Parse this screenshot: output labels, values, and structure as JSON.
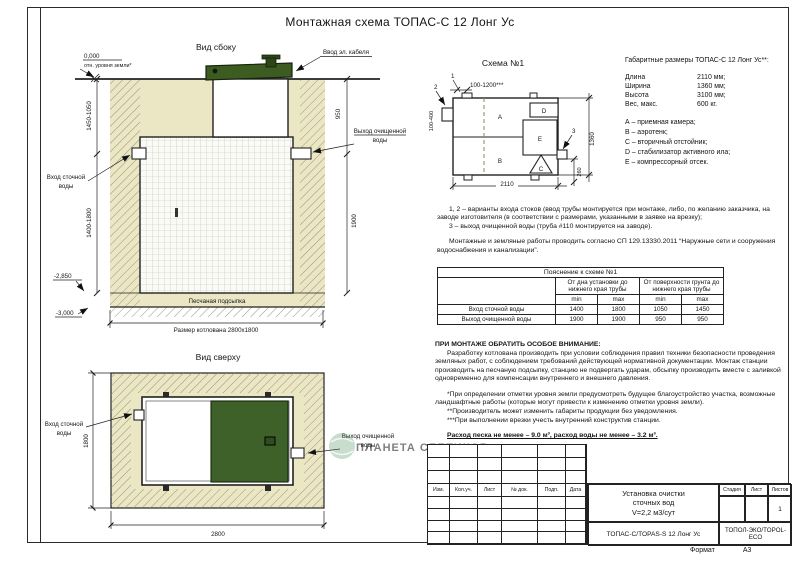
{
  "colors": {
    "sand": "#ebe6c4",
    "lid_green": "#3c5c22",
    "watermark_green": "#9ecfb6",
    "line": "#1a1a1a"
  },
  "page": {
    "title": "Монтажная схема ТОПАС-С 12 Лонг Ус",
    "format_label": "Формат",
    "format_value": "А3"
  },
  "side_view": {
    "title": "Вид сбоку",
    "zero_level": "0,000",
    "zero_note": "отн. уровня земли*",
    "cable_label": "Ввод эл. кабеля",
    "inlet_label": [
      "Вход сточной",
      "воды"
    ],
    "outlet_label": [
      "Выход очищенной",
      "воды"
    ],
    "sand_label": "Песчаная подсыпка",
    "pit_label": "Размер котлована 2800х1800",
    "dims": {
      "ground_to_inlet": "1450-1050",
      "inlet_to_bottom": "1400-1800",
      "level_sand": "-2,850",
      "level_bottom": "-3,000",
      "ground_to_outlet": "950",
      "outlet_to_bottom": "1900"
    }
  },
  "schema": {
    "title": "Схема №1",
    "compartments": [
      "A",
      "B",
      "C",
      "D",
      "E"
    ],
    "callouts": [
      "1",
      "2",
      "3"
    ],
    "dims": {
      "top": "100-1200***",
      "left": "100-400",
      "right": "1360",
      "outlet": "260",
      "bottom": "2110"
    }
  },
  "specs": {
    "title": "Габаритные размеры ТОПАС-С 12 Лонг Ус**:",
    "rows": [
      {
        "label": "Длина",
        "value": "2110 мм;"
      },
      {
        "label": "Ширина",
        "value": "1360 мм;"
      },
      {
        "label": "Высота",
        "value": "3100 мм;"
      },
      {
        "label": "Вес, макс.",
        "value": "600 кг."
      }
    ],
    "legend": [
      "А – приемная камера;",
      "В – аэротенк;",
      "С – вторичный отстойник;",
      "D – стабилизатор активного ила;",
      "Е – компрессорный отсек."
    ]
  },
  "notes": {
    "item12": "1, 2 – варианты входа стоков (ввод трубы монтируется при монтаже, либо, по желанию заказчика, на заводе изготовителя (в соответствии с размерами, указанными в заявке на врезку);",
    "item3": "3 – выход очищенной воды (труба #110 монтируется на заводе).",
    "norm": "Монтажные и земляные работы проводить согласно СП 129.13330.2011 “Наружные сети и сооружения водоснабжения и канализации”."
  },
  "explanation_table": {
    "title": "Пояснение к схеме №1",
    "group1": "От дна установки до нижнего края трубы",
    "group2": "От поверхности грунта до нижнего края трубы",
    "sub": [
      "min",
      "max",
      "min",
      "max"
    ],
    "rows": [
      {
        "label": "Вход сточной воды",
        "v": [
          "1400",
          "1800",
          "1050",
          "1450"
        ]
      },
      {
        "label": "Выход очищенной воды",
        "v": [
          "1900",
          "1900",
          "950",
          "950"
        ]
      }
    ]
  },
  "attention": {
    "title": "ПРИ МОНТАЖЕ ОБРАТИТЬ ОСОБОЕ ВНИМАНИЕ:",
    "p1": "Разработку котлована производить при условии соблюдения правил техники безопасности проведения земляных работ, с соблюдением требований действующей нормативной документации. Монтаж станции производить на песчаную подсыпку, станцию не подвергать ударам, обсыпку производить вместе с заливкой одновременно для компенсации внутреннего и внешнего давления.",
    "f1": "*При определении отметки уровня земли предусмотреть будущее благоустройство участка, возможные ландшафтные работы (которые могут привести к изменению отметки уровня земли).",
    "f2": "**Производитель может изменить габариты продукции без уведомления.",
    "f3": "***При выполнении врезки учесть внутренний конструктив станции.",
    "consumption": "Расход песка не менее – 9.0 м³, расход воды не менее – 3.2 м³."
  },
  "top_view": {
    "title": "Вид сверху",
    "inlet_label": [
      "Вход сточной",
      "воды"
    ],
    "outlet_label": [
      "Выход очищенной",
      "воды"
    ],
    "dims": {
      "width": "1800",
      "length": "2800"
    },
    "watermark": "ПЛАНЕТА СЕПТИКОВ"
  },
  "title_block": {
    "rev_headers": [
      "Изм.",
      "Кол.уч.",
      "Лист",
      "№ док.",
      "Подп.",
      "Дата"
    ],
    "title_lines": [
      "Установка очистки",
      "сточных вод",
      "V=2,2 м3/сут"
    ],
    "doc_code": "ТОПАС-С/TOPAS-S 12 Лонг Ус",
    "company": "ТОПОЛ-ЭКО/TOPOL-ECO",
    "stage_headers": [
      "Стадия",
      "Лист",
      "Листов"
    ],
    "sheets_value": "1"
  }
}
